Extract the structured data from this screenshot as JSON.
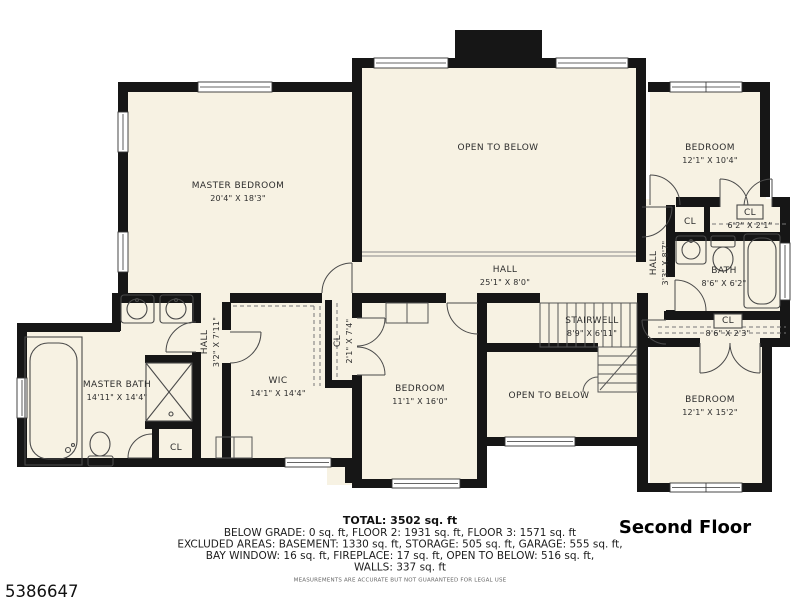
{
  "floor_title": "Second Floor",
  "listing_id": "5386647",
  "disclaimer": "MEASUREMENTS ARE ACCURATE BUT NOT GUARANTEED FOR LEGAL USE",
  "summary": {
    "total": "TOTAL: 3502 sq. ft",
    "line2": "BELOW GRADE: 0 sq. ft, FLOOR 2: 1931 sq. ft, FLOOR 3: 1571 sq. ft",
    "line3": "EXCLUDED AREAS: BASEMENT: 1330 sq. ft, STORAGE: 505 sq. ft, GARAGE: 555 sq. ft,",
    "line4": "BAY WINDOW: 16 sq. ft, FIREPLACE: 17 sq. ft, OPEN TO BELOW: 516 sq. ft,",
    "line5": "WALLS: 337 sq. ft"
  },
  "colors": {
    "floor": "#f7f2e3",
    "wall": "#161616"
  },
  "rooms": [
    {
      "id": "master-bedroom",
      "label": "MASTER BEDROOM",
      "dims": "20'4\" X 18'3\"",
      "x": 238,
      "y": 188,
      "rotate": 0
    },
    {
      "id": "open-to-below-upper",
      "label": "OPEN TO BELOW",
      "dims": null,
      "x": 498,
      "y": 150,
      "rotate": 0
    },
    {
      "id": "hall-upper",
      "label": "HALL",
      "dims": "25'1\" X 8'0\"",
      "x": 505,
      "y": 272,
      "rotate": 0
    },
    {
      "id": "bedroom-upper-right",
      "label": "BEDROOM",
      "dims": "12'1\" X 10'4\"",
      "x": 710,
      "y": 150,
      "rotate": 0
    },
    {
      "id": "closet-hall-right",
      "label": "CL",
      "dims": null,
      "x": 690,
      "y": 224,
      "rotate": 0
    },
    {
      "id": "closet-6-2",
      "label": "CL",
      "dims": "6'2\" X 2'1\"",
      "x": 750,
      "y": 215,
      "rotate": 0
    },
    {
      "id": "hall-right",
      "label": "HALL",
      "dims": "3'3\" X 8'7\"",
      "x": 656,
      "y": 263,
      "rotate": -90
    },
    {
      "id": "bath",
      "label": "BATH",
      "dims": "8'6\" X 6'2\"",
      "x": 724,
      "y": 273,
      "rotate": 0
    },
    {
      "id": "closet-8-6",
      "label": "CL",
      "dims": "8'6\" X 2'3\"",
      "x": 728,
      "y": 323,
      "rotate": 0
    },
    {
      "id": "bedroom-lower-right",
      "label": "BEDROOM",
      "dims": "12'1\" X 15'2\"",
      "x": 710,
      "y": 402,
      "rotate": 0
    },
    {
      "id": "stairwell",
      "label": "STAIRWELL",
      "dims": "8'9\" X 6'11\"",
      "x": 592,
      "y": 323,
      "rotate": 0
    },
    {
      "id": "open-to-below-lower",
      "label": "OPEN TO BELOW",
      "dims": null,
      "x": 549,
      "y": 398,
      "rotate": 0
    },
    {
      "id": "bedroom-center",
      "label": "BEDROOM",
      "dims": "11'1\" X 16'0\"",
      "x": 420,
      "y": 391,
      "rotate": 0
    },
    {
      "id": "closet-2-1",
      "label": "CL",
      "dims": "2'1\" X 7'4\"",
      "x": 340,
      "y": 341,
      "rotate": -90
    },
    {
      "id": "wic",
      "label": "WIC",
      "dims": "14'1\" X 14'4\"",
      "x": 278,
      "y": 383,
      "rotate": 0
    },
    {
      "id": "hall-master",
      "label": "HALL",
      "dims": "3'2\" X 7'11\"",
      "x": 207,
      "y": 342,
      "rotate": -90
    },
    {
      "id": "master-bath",
      "label": "MASTER BATH",
      "dims": "14'11\" X 14'4\"",
      "x": 117,
      "y": 387,
      "rotate": 0
    },
    {
      "id": "closet-master-bath",
      "label": "CL",
      "dims": null,
      "x": 176,
      "y": 450,
      "rotate": 0
    }
  ]
}
